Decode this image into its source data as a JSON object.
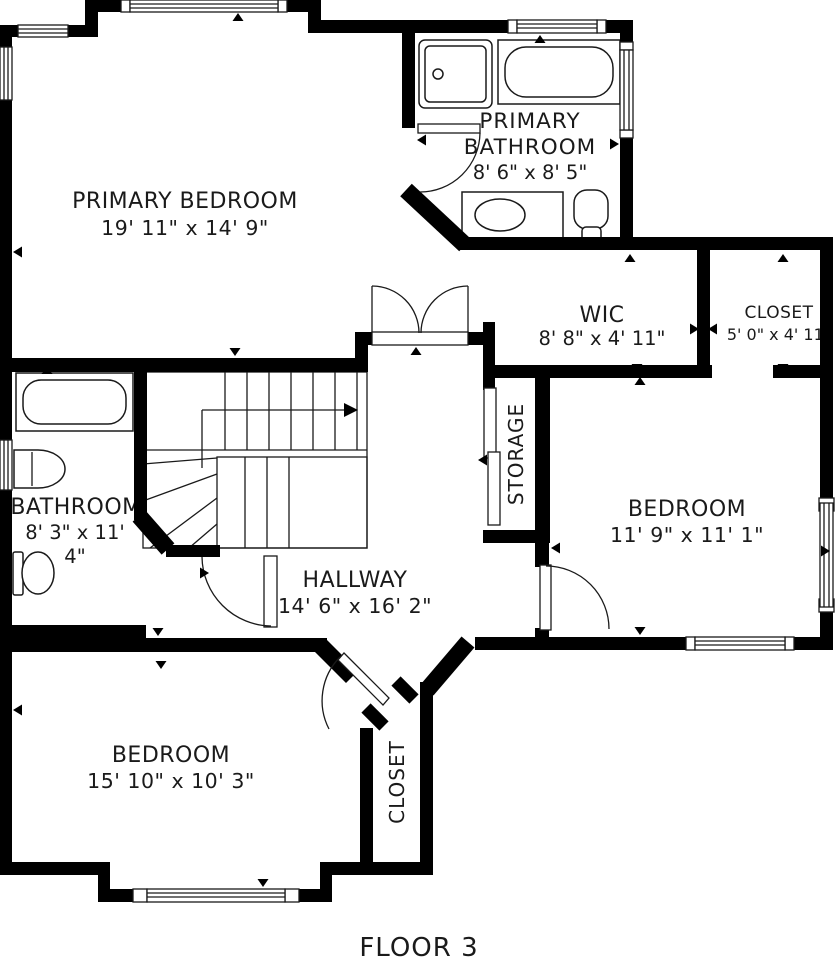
{
  "floor": {
    "label": "FLOOR 3"
  },
  "rooms": {
    "primary_bedroom": {
      "name": "PRIMARY BEDROOM",
      "dims": "19' 11\" x 14' 9\""
    },
    "primary_bathroom": {
      "name_line1": "PRIMARY",
      "name_line2": "BATHROOM",
      "dims": "8' 6\" x 8' 5\""
    },
    "wic": {
      "name": "WIC",
      "dims": "8' 8\" x 4' 11\""
    },
    "closet_upper": {
      "name": "CLOSET",
      "dims": "5' 0\" x 4' 11\""
    },
    "bathroom": {
      "name": "BATHROOM",
      "dims_line1": "8' 3\" x 11'",
      "dims_line2": "4\""
    },
    "storage": {
      "name": "STORAGE"
    },
    "bedroom_right": {
      "name": "BEDROOM",
      "dims": "11' 9\" x 11' 1\""
    },
    "hallway": {
      "name": "HALLWAY",
      "dims": "14' 6\" x 16' 2\""
    },
    "bedroom_lower": {
      "name": "BEDROOM",
      "dims": "15' 10\" x 10' 3\""
    },
    "closet_lower": {
      "name": "CLOSET"
    }
  },
  "colors": {
    "wall": "#000000",
    "line": "#1a1a1a",
    "background": "#ffffff",
    "text": "#1a1a1a"
  }
}
